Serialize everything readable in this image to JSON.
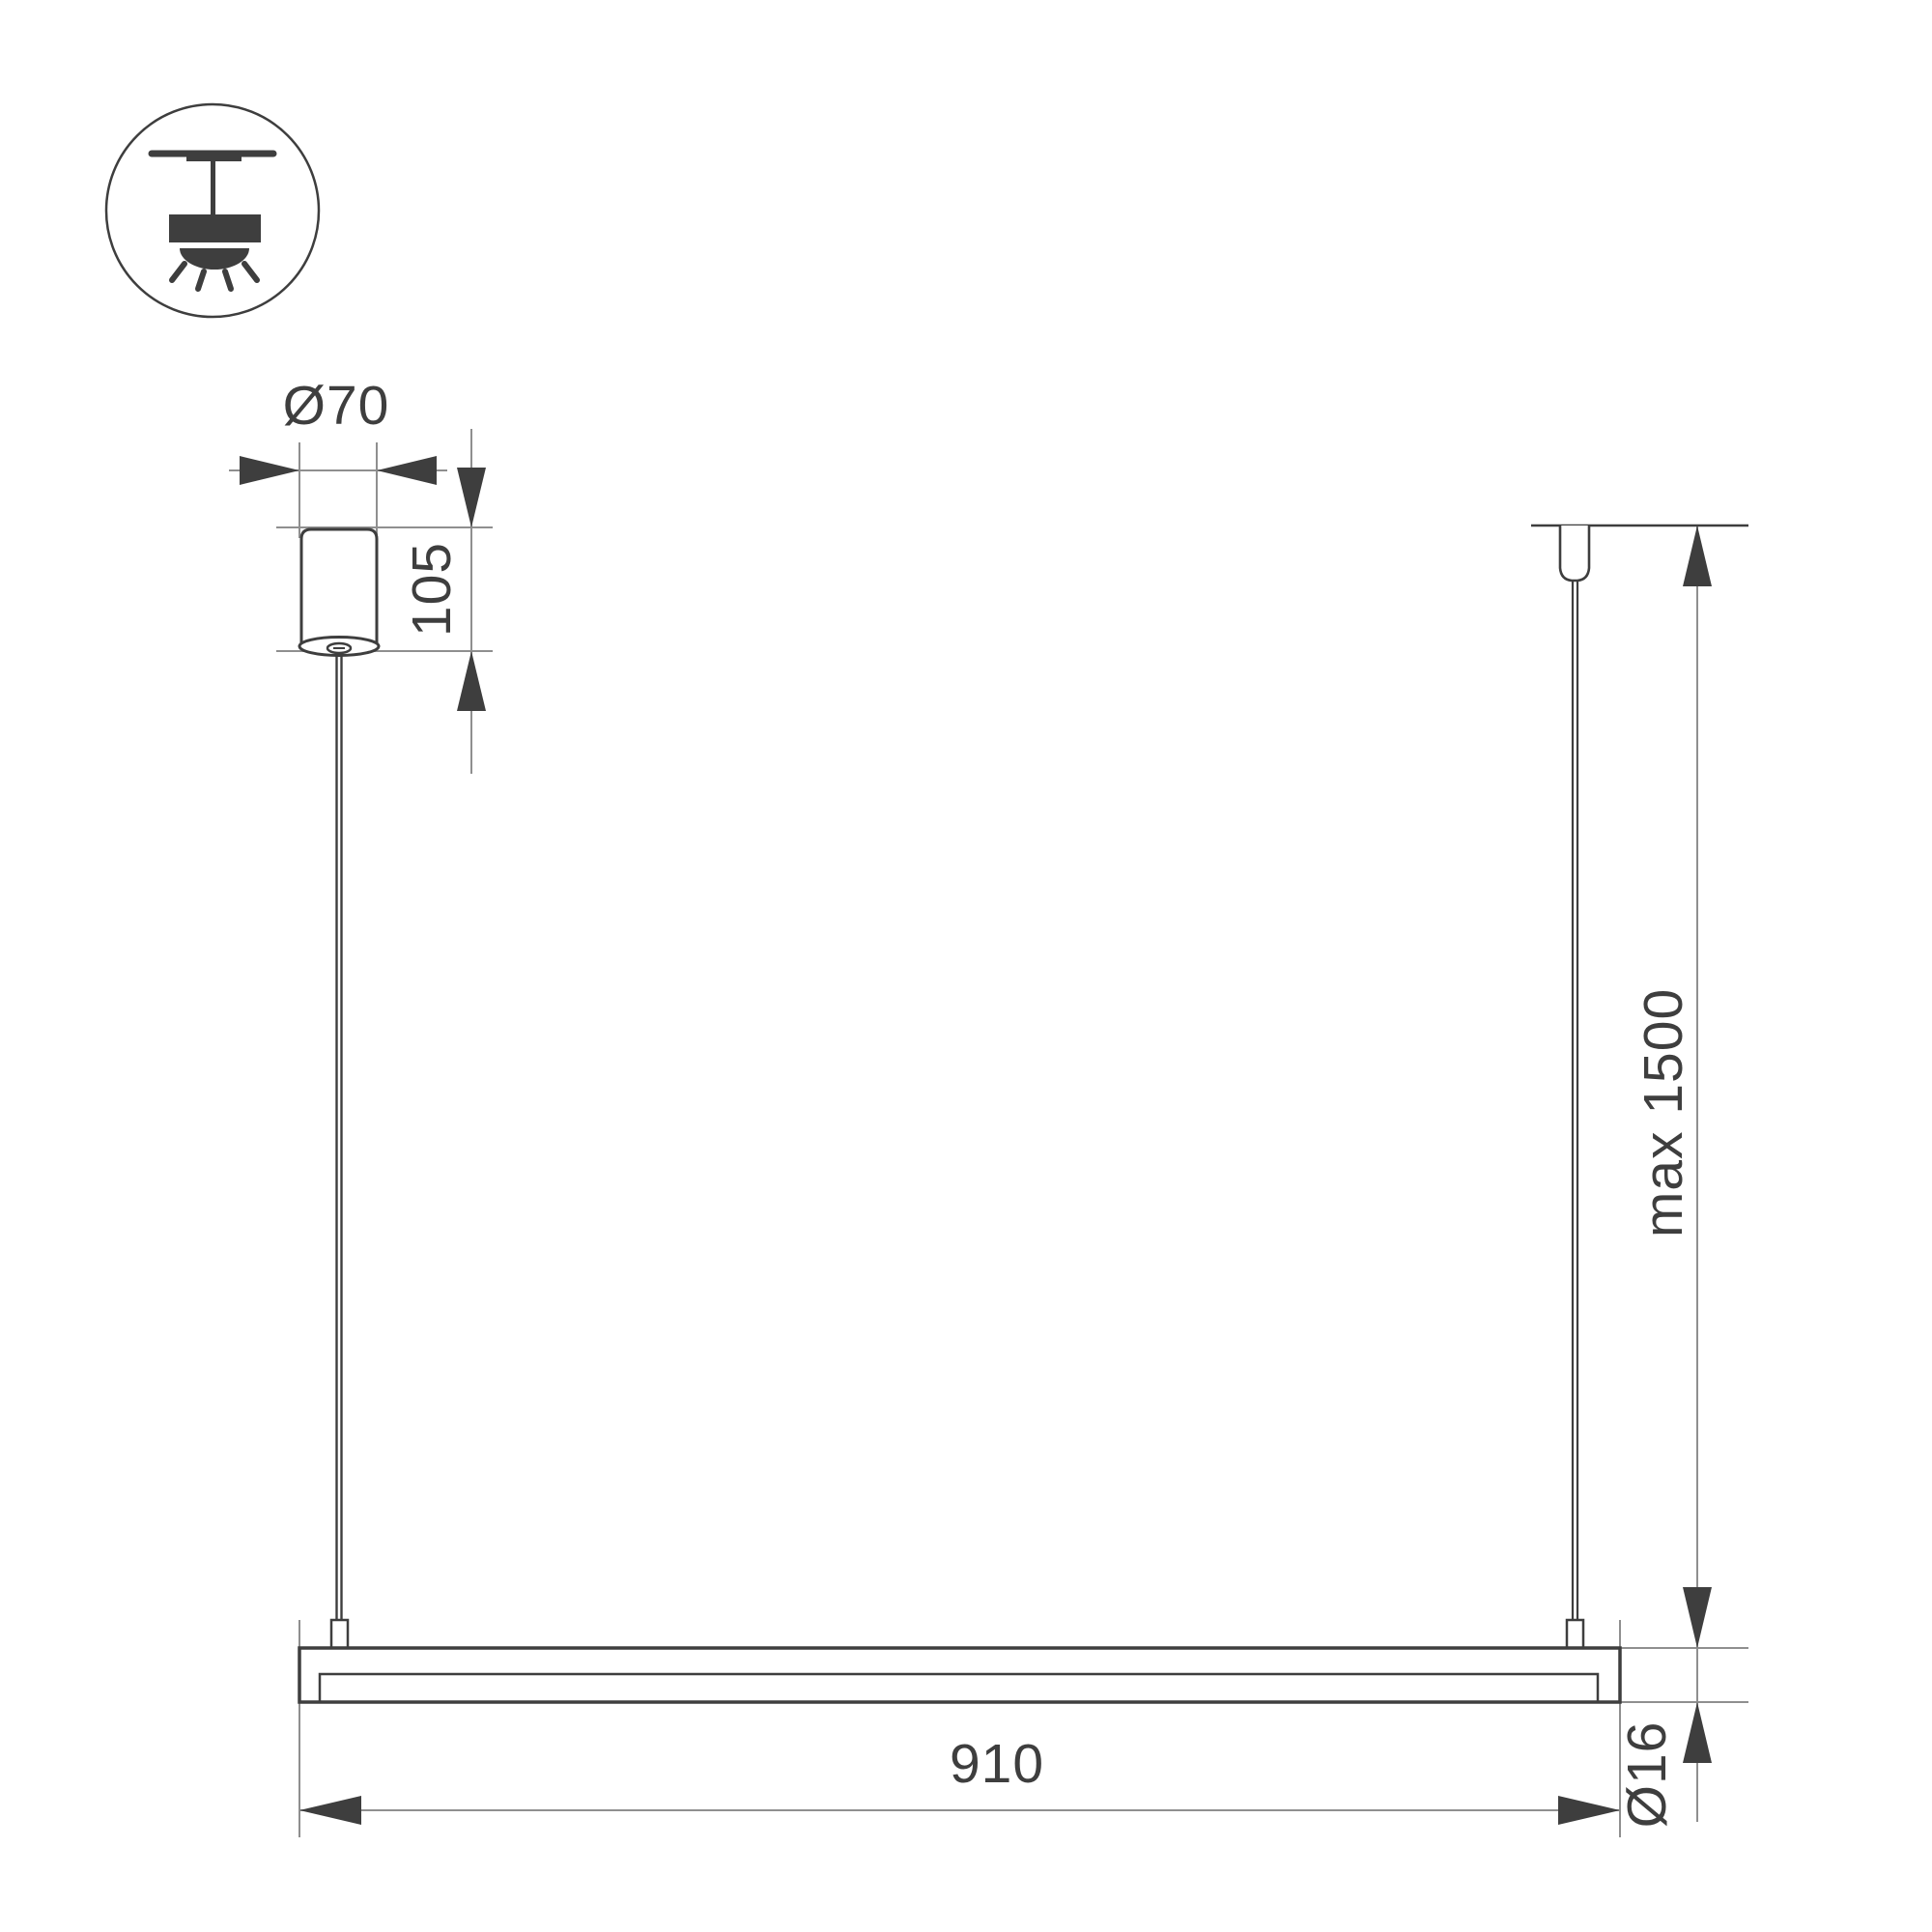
{
  "drawing": {
    "icon": "ceiling-pendant-mount",
    "labels": {
      "canopy_diameter": "Ø70",
      "canopy_height": "105",
      "max_suspension": "max 1500",
      "fixture_length": "910",
      "profile_diameter": "Ø16"
    },
    "colors": {
      "ink": "#3e3e3e",
      "extension_line": "#8f8f8f",
      "background": "#ffffff"
    }
  }
}
